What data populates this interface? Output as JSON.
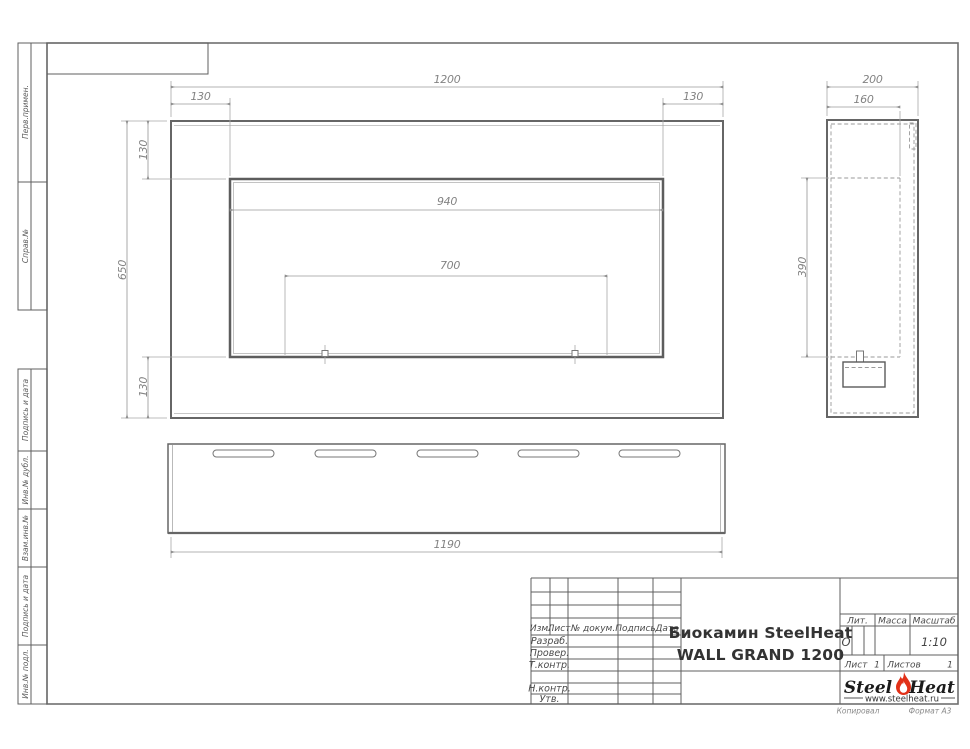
{
  "margin_labels": {
    "items": [
      "Перв.примен.",
      "Справ.№",
      "Подпись и дата",
      "Инв.№ дубл.",
      "Взам.инв.№",
      "Подпись и дата",
      "Инв.№ подл."
    ]
  },
  "dims": {
    "front_width": "1200",
    "front_height": "650",
    "front_margin_left": "130",
    "front_margin_right": "130",
    "front_margin_top": "130",
    "front_margin_bottom": "130",
    "front_opening_width": "940",
    "front_burner_span": "700",
    "side_depth": "200",
    "side_inner_depth": "160",
    "side_opening_height": "390",
    "bottom_width": "1190"
  },
  "title_block": {
    "header": {
      "izm": "Изм.",
      "list": "Лист",
      "doc": "№ докум.",
      "sign": "Подпись",
      "date": "Дата"
    },
    "rows": {
      "developed": "Разраб.",
      "checked": "Провер.",
      "tcontrol": "Т.контр.",
      "ncontrol": "Н.контр.",
      "approved": "Утв."
    },
    "product_line1": "Биокамин SteelHeat",
    "product_line2": "WALL GRAND 1200",
    "lit_label": "Лит.",
    "lit_value": "О",
    "mass_label": "Масса",
    "scale_label": "Масштаб",
    "scale_value": "1:10",
    "sheet_label": "Лист",
    "sheet_value": "1",
    "sheets_label": "Листов",
    "sheets_value": "1",
    "brand": {
      "steel": "Steel",
      "heat": "Heat",
      "url": "www.steelheat.ru"
    }
  },
  "footer": {
    "copy": "Копировал",
    "format": "Формат А3"
  },
  "colors": {
    "line": "#8c8c8c",
    "object": "#5f5f5f",
    "dim_text": "#808080",
    "flame": "#e23118"
  }
}
